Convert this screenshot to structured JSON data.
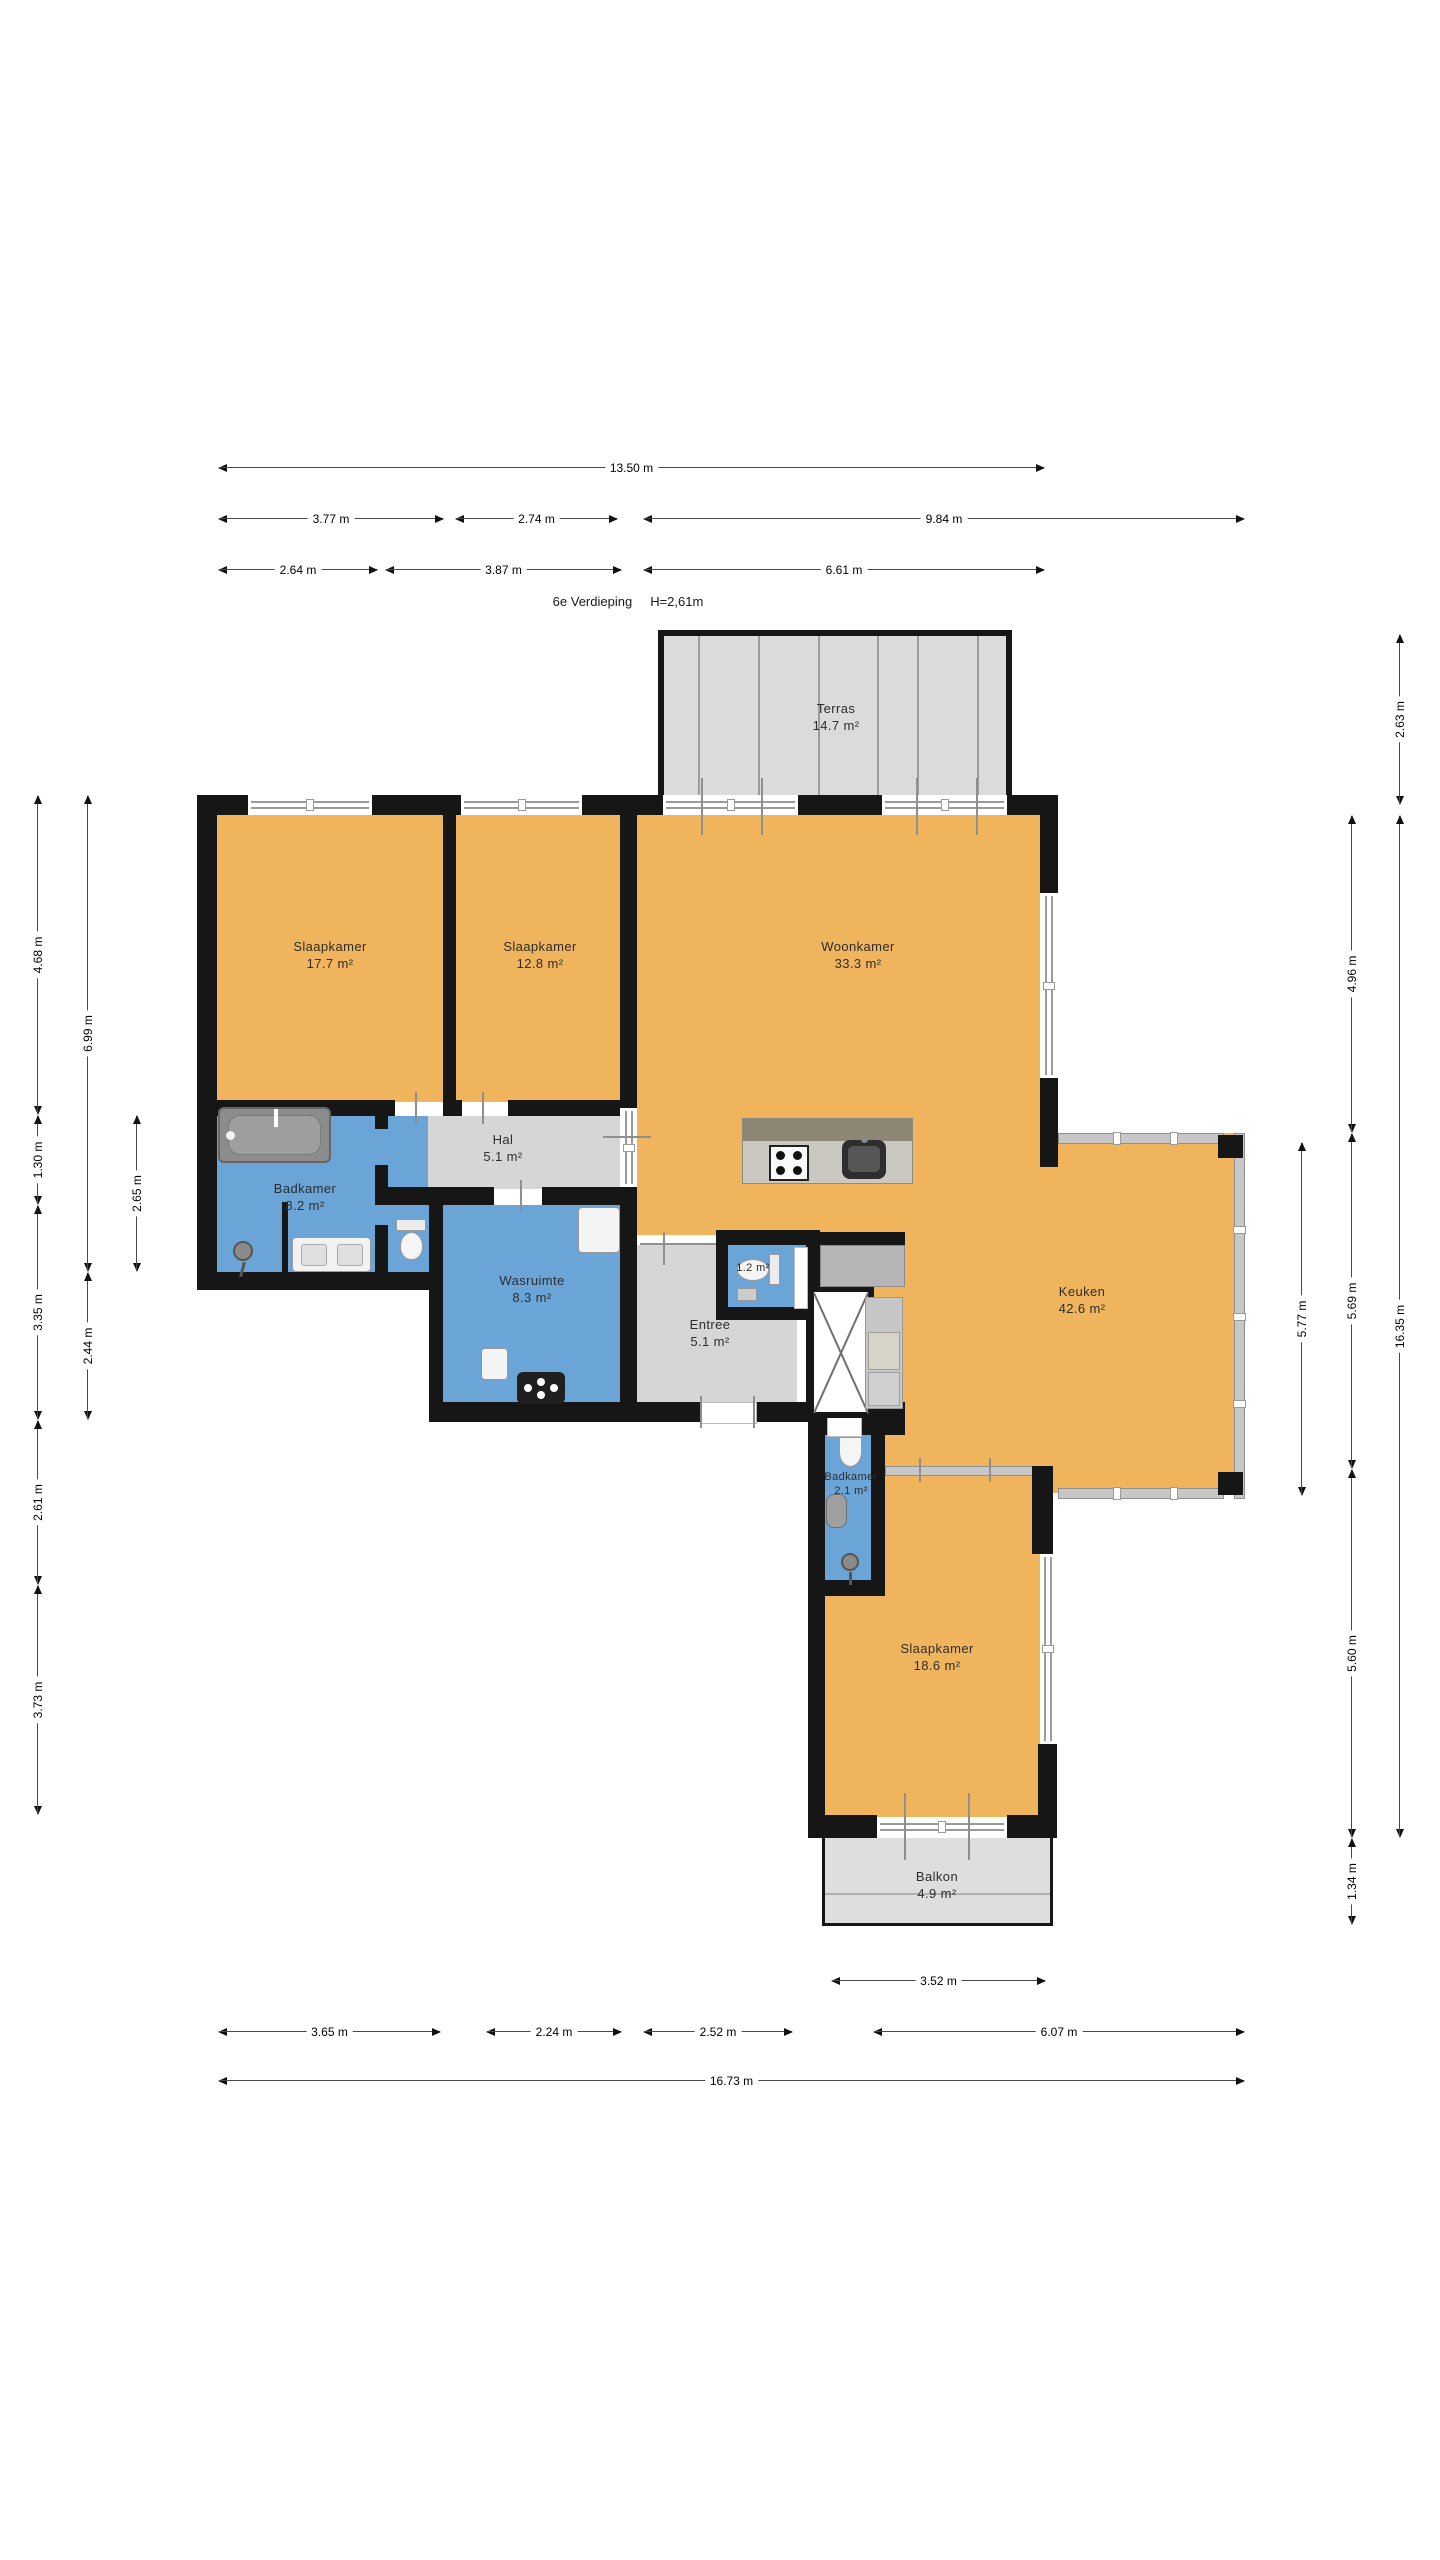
{
  "title": {
    "floor_label": "6e Verdieping",
    "ceiling_height": "H=2,61m"
  },
  "rooms": {
    "terras": {
      "name": "Terras",
      "area": "14.7 m²"
    },
    "slaapkamer_1": {
      "name": "Slaapkamer",
      "area": "17.7 m²"
    },
    "slaapkamer_2": {
      "name": "Slaapkamer",
      "area": "12.8 m²"
    },
    "woonkamer": {
      "name": "Woonkamer",
      "area": "33.3 m²"
    },
    "hal": {
      "name": "Hal",
      "area": "5.1 m²"
    },
    "badkamer_1": {
      "name": "Badkamer",
      "area": "8.2 m²"
    },
    "wasruimte": {
      "name": "Wasruimte",
      "area": "8.3 m²"
    },
    "toilet": {
      "area": "1.2 m²"
    },
    "entree": {
      "name": "Entree",
      "area": "5.1 m²"
    },
    "keuken": {
      "name": "Keuken",
      "area": "42.6 m²"
    },
    "badkamer_2": {
      "name": "Badkamer",
      "area": "2.1 m²"
    },
    "slaapkamer_3": {
      "name": "Slaapkamer",
      "area": "18.6 m²"
    },
    "balkon": {
      "name": "Balkon",
      "area": "4.9 m²"
    }
  },
  "dimensions": {
    "top": [
      {
        "text": "13.50 m"
      },
      {
        "text": "3.77 m"
      },
      {
        "text": "2.74 m"
      },
      {
        "text": "9.84 m"
      },
      {
        "text": "2.64 m"
      },
      {
        "text": "3.87 m"
      },
      {
        "text": "6.61 m"
      }
    ],
    "bottom": [
      {
        "text": "3.52 m"
      },
      {
        "text": "3.65 m"
      },
      {
        "text": "2.24 m"
      },
      {
        "text": "2.52 m"
      },
      {
        "text": "6.07 m"
      },
      {
        "text": "16.73 m"
      }
    ],
    "left": [
      {
        "text": "4.68 m"
      },
      {
        "text": "1.30 m"
      },
      {
        "text": "3.35 m"
      },
      {
        "text": "2.61 m"
      },
      {
        "text": "3.73 m"
      },
      {
        "text": "6.99 m"
      },
      {
        "text": "2.44 m"
      },
      {
        "text": "2.65 m"
      }
    ],
    "right": [
      {
        "text": "2.63 m"
      },
      {
        "text": "4.96 m"
      },
      {
        "text": "5.69 m"
      },
      {
        "text": "5.60 m"
      },
      {
        "text": "1.34 m"
      },
      {
        "text": "5.77 m"
      },
      {
        "text": "16.35 m"
      }
    ]
  },
  "colors": {
    "room_orange": "#F0B45C",
    "wet_room_blue": "#6BA5D8",
    "circulation_gray": "#D6D6D6",
    "outdoor_gray": "#DBDBDB",
    "wall_black": "#161616"
  }
}
